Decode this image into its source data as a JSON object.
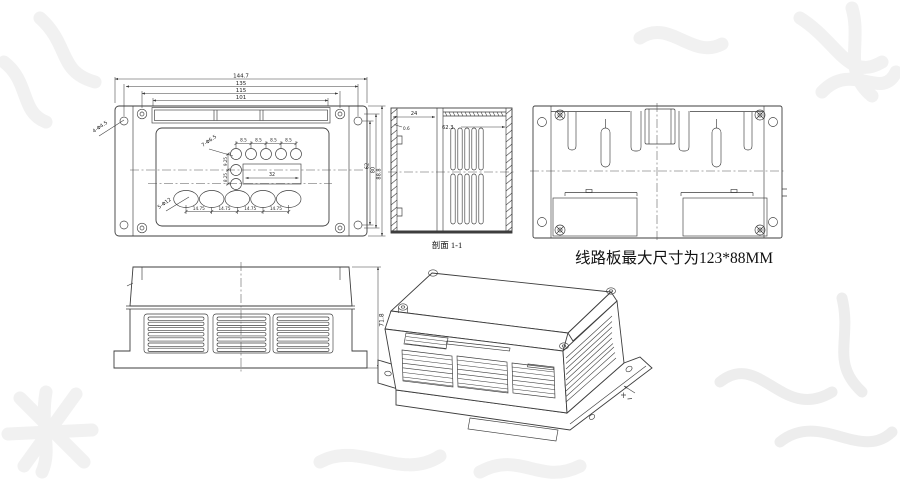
{
  "title": "enclosure engineering drawing",
  "note": "线路板最大尺寸为123*88MM",
  "top_view": {
    "dim_width_outer": "144.7",
    "dim_width_holes": "135",
    "dim_width_screws": "115",
    "dim_width_slot": "101",
    "dim_height_outer": "88.8",
    "dim_height_screws": "80",
    "dim_height_holes": "62",
    "label_corner_holes": "4-Φ4.5",
    "label_small_holes": "7-Φ6.5",
    "label_large_holes": "5-Φ12",
    "pitch_small": [
      "8.5",
      "8.5",
      "8.5",
      "8.5"
    ],
    "pitch_row1": "9.25",
    "pitch_row2": "8.25",
    "dim_window": "32",
    "pitch_large": [
      "14.75",
      "14.75",
      "14.75",
      "14.75"
    ]
  },
  "section_view": {
    "caption": "剖面 1-1",
    "dim_depth": "24",
    "dim_wall": "0.6",
    "dim_vent": "62.3"
  },
  "front_view": {
    "dim_height": "71.8"
  },
  "colors": {
    "line": "#3d3d3d",
    "watermark": "#f1f1f1"
  }
}
